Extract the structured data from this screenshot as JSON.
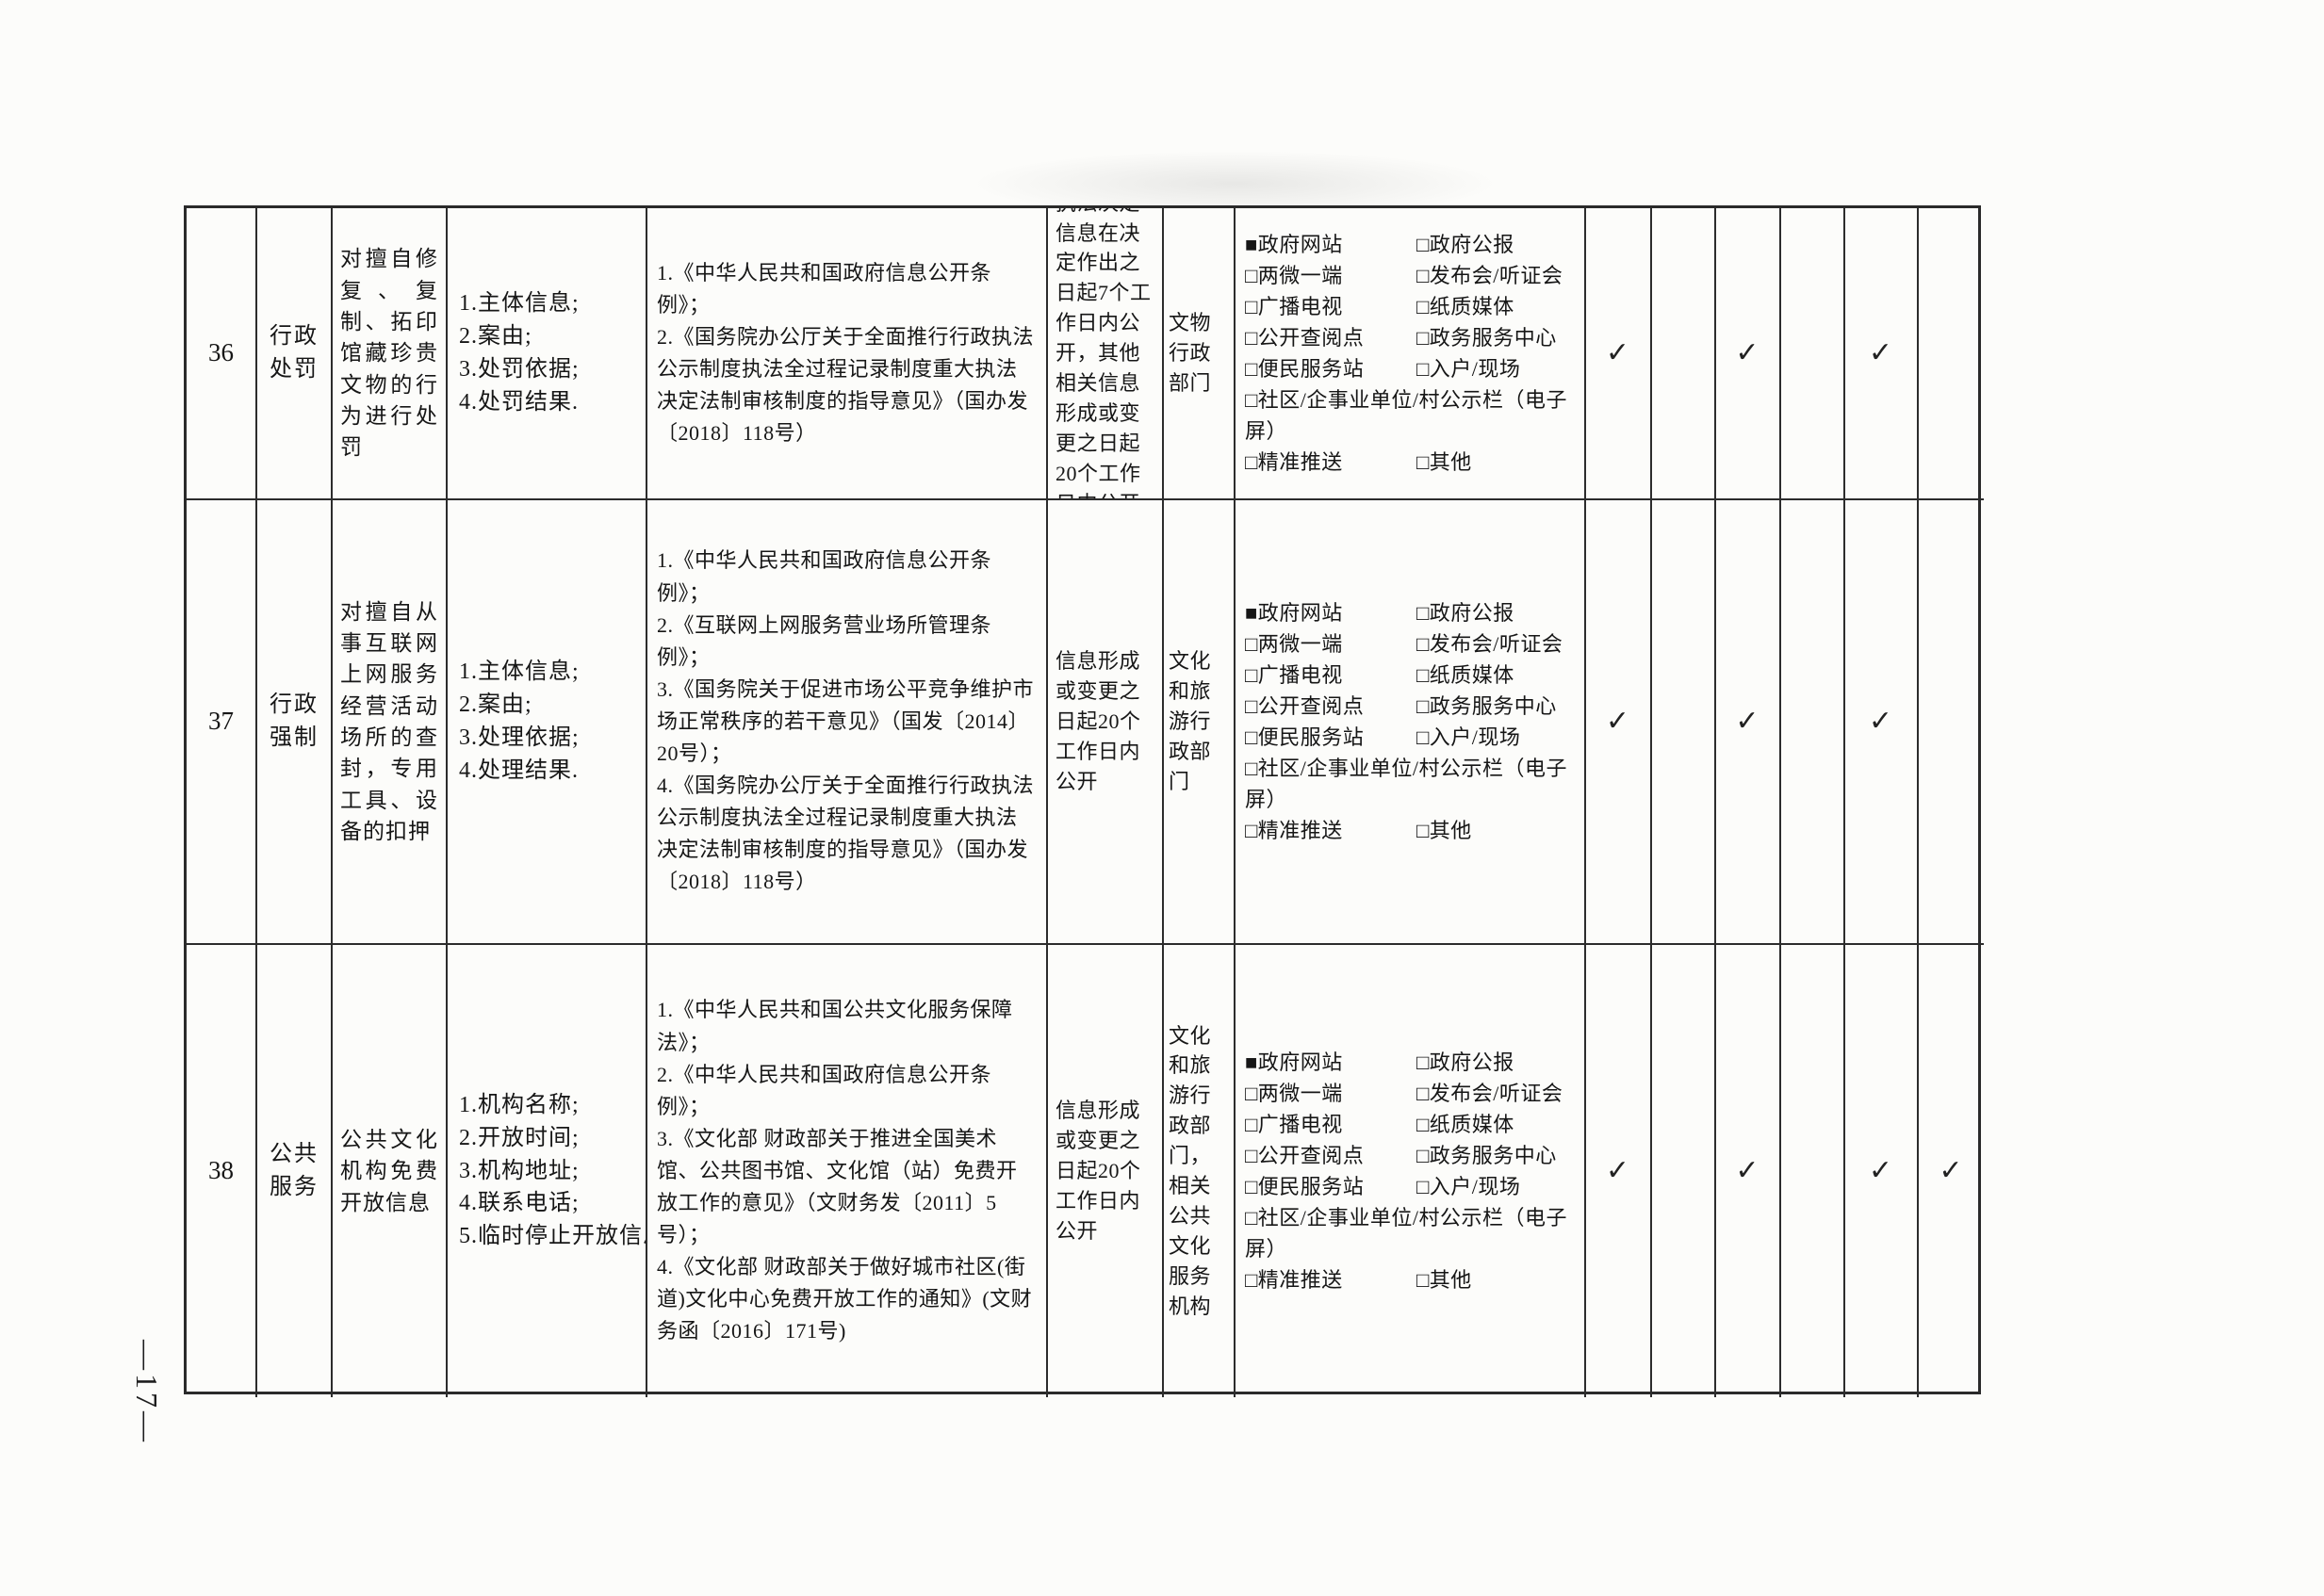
{
  "page": {
    "number": "—17—"
  },
  "colors": {
    "paper": "#fcfcfa",
    "ink": "#161616",
    "line": "#2a2a2a"
  },
  "channels": {
    "lines": [
      {
        "left": "■政府网站",
        "right": "□政府公报"
      },
      {
        "left": "□两微一端",
        "right": "□发布会/听证会"
      },
      {
        "left": "□广播电视",
        "right": "□纸质媒体"
      },
      {
        "left": "□公开查阅点",
        "right": "□政务服务中心"
      },
      {
        "left": "□便民服务站",
        "right": "□入户/现场"
      },
      {
        "full": "□社区/企事业单位/村公示栏（电子屏）"
      },
      {
        "left": "□精准推送",
        "right": "□其他"
      }
    ]
  },
  "rows": [
    {
      "number": "36",
      "category": "行政处罚",
      "item": "对擅自修复、复制、拓印馆藏珍贵文物的行为进行处罚",
      "content": [
        "1.主体信息;",
        "2.案由;",
        "3.处罚依据;",
        "4.处罚结果."
      ],
      "basis": [
        "1.《中华人民共和国政府信息公开条例》；",
        "2.《国务院办公厅关于全面推行行政执法公示制度执法全过程记录制度重大执法决定法制审核制度的指导意见》（国办发〔2018〕118号）"
      ],
      "timing": "执法决定信息在决定作出之日起7个工作日内公开，其他相关信息形成或变更之日起20个工作日内公开",
      "responsible": "文物行政部门",
      "marks": [
        "✓",
        "",
        "✓",
        "",
        "✓",
        ""
      ]
    },
    {
      "number": "37",
      "category": "行政强制",
      "item": "对擅自从事互联网上网服务经营活动场所的查封，专用工具、设备的扣押",
      "content": [
        "1.主体信息;",
        "2.案由;",
        "3.处理依据;",
        "4.处理结果."
      ],
      "basis": [
        "1.《中华人民共和国政府信息公开条例》；",
        "2.《互联网上网服务营业场所管理条例》；",
        "3.《国务院关于促进市场公平竞争维护市场正常秩序的若干意见》（国发〔2014〕20号）；",
        "4.《国务院办公厅关于全面推行行政执法公示制度执法全过程记录制度重大执法决定法制审核制度的指导意见》（国办发〔2018〕118号）"
      ],
      "timing": "信息形成或变更之日起20个工作日内公开",
      "responsible": "文化和旅游行政部门",
      "marks": [
        "✓",
        "",
        "✓",
        "",
        "✓",
        ""
      ]
    },
    {
      "number": "38",
      "category": "公共服务",
      "item": "公共文化机构免费开放信息",
      "content": [
        "1.机构名称;",
        "2.开放时间;",
        "3.机构地址;",
        "4.联系电话;",
        "5.临时停止开放信息."
      ],
      "basis": [
        "1.《中华人民共和国公共文化服务保障法》；",
        "2.《中华人民共和国政府信息公开条例》；",
        "3.《文化部 财政部关于推进全国美术馆、公共图书馆、文化馆（站）免费开放工作的意见》（文财务发〔2011〕5号）；",
        "4.《文化部 财政部关于做好城市社区(街道)文化中心免费开放工作的通知》(文财务函〔2016〕171号)"
      ],
      "timing": "信息形成或变更之日起20个工作日内公开",
      "responsible": "文化和旅游行政部门，相关公共文化服务机构",
      "marks": [
        "✓",
        "",
        "✓",
        "",
        "✓",
        "✓"
      ]
    }
  ]
}
